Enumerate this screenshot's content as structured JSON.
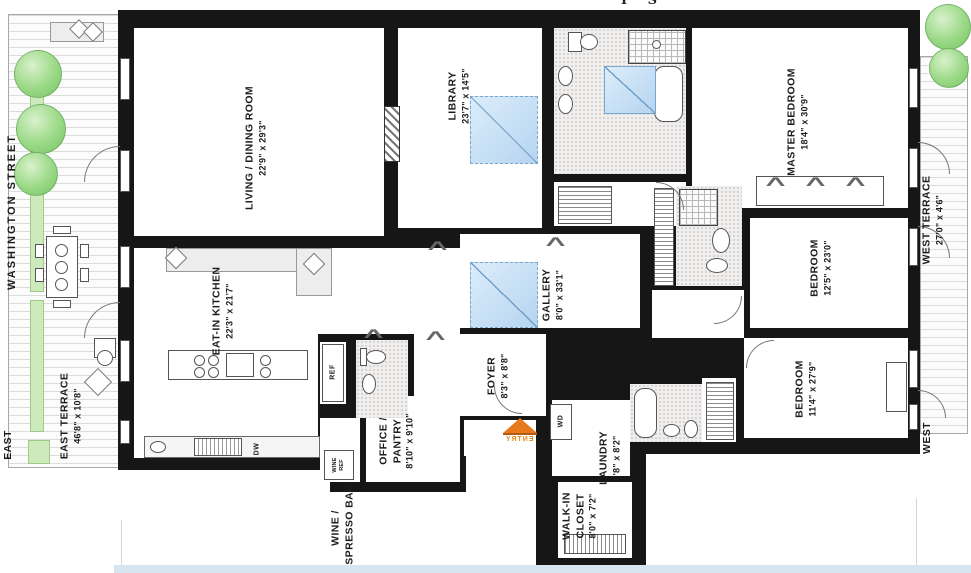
{
  "plan_title": "apartment-floor-plan",
  "streets": {
    "left_street": "WASHINGTON STREET",
    "east": "EAST",
    "west": "WEST"
  },
  "entry_label": "ENTRY",
  "top_edge_fragment": "I S",
  "appliances": {
    "ref": "REF",
    "dw": "DW",
    "wd": "WD",
    "wine_ref_1": "WINE",
    "wine_ref_2": "REF"
  },
  "rooms": [
    {
      "id": "living-dining",
      "name": "LIVING / DINING ROOM",
      "dims": "22'9\" x 29'3\""
    },
    {
      "id": "library",
      "name": "LIBRARY",
      "dims": "23'7\" x 14'5\""
    },
    {
      "id": "master-bedroom",
      "name": "MASTER BEDROOM",
      "dims": "18'4\" x 30'9\""
    },
    {
      "id": "bedroom-2",
      "name": "BEDROOM",
      "dims": "12'5\" x 23'0\""
    },
    {
      "id": "bedroom-3",
      "name": "BEDROOM",
      "dims": "11'4\" x 27'9\""
    },
    {
      "id": "eat-in-kitchen",
      "name": "EAT-IN KITCHEN",
      "dims": "22'3\" x 21'7\""
    },
    {
      "id": "gallery",
      "name": "GALLERY",
      "dims": "8'0\" x 33'1\""
    },
    {
      "id": "foyer",
      "name": "FOYER",
      "dims": "8'3\" x 8'8\""
    },
    {
      "id": "laundry",
      "name": "LAUNDRY",
      "dims": "6'8\" x 8'2\""
    },
    {
      "id": "walk-in-closet",
      "name": "WALK-IN",
      "name2": "CLOSET",
      "dims": "8'0\" x 7'2\""
    },
    {
      "id": "office-pantry",
      "name": "OFFICE /",
      "name2": "PANTRY",
      "dims": "8'10\" x 9'10\""
    },
    {
      "id": "wine-espresso",
      "name": "WINE /",
      "name2": "ESPRESSO BAR"
    },
    {
      "id": "east-terrace",
      "name": "EAST TERRACE",
      "dims": "46'8\" x 10'8\""
    },
    {
      "id": "west-terrace",
      "name": "WEST TERRACE",
      "dims": "27'0\" x 4'6\""
    }
  ],
  "colors": {
    "wall": "#161616",
    "room": "#ffffff",
    "skylight": "#b5d4f0",
    "tree": "#8fd47f",
    "planter": "#cdeabc",
    "entry_arrow": "#e8791c",
    "terrace_plank": "#dcdcdc",
    "bottom_strip": "#d7e5f0"
  }
}
